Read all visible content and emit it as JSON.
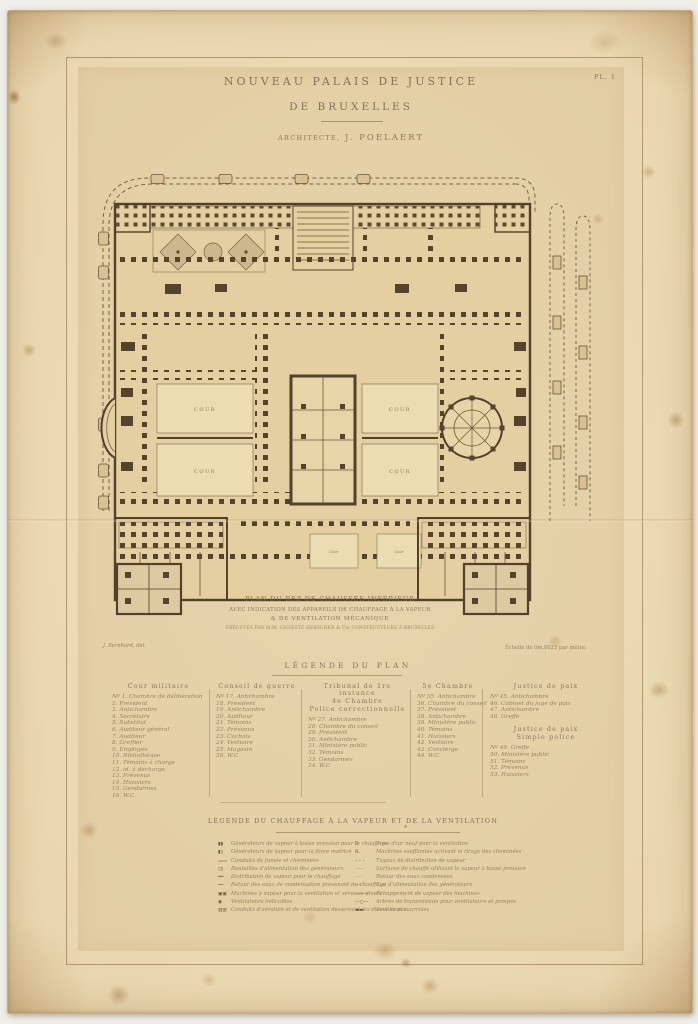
{
  "plate": {
    "number": "PL. 1",
    "title_line1": "NOUVEAU PALAIS DE JUSTICE",
    "title_line2": "DE BRUXELLES",
    "architect_prefix": "ARCHITECTE,",
    "architect_name": "J. POELAERT"
  },
  "plan": {
    "courtyard_label": "COUR",
    "small_court_label": "Cour",
    "caption_line1": "PLAN DU REZ DE CHAUSSÉE INFÉRIEUR",
    "caption_line2": "AVEC INDICATION DES APPAREILS DE CHAUFFAGE À LA VAPEUR",
    "caption_line3": "& DE VENTILATION MÉCANIQUE",
    "caption_line4": "EXÉCUTÉS PAR M.M. GENESTE HERSCHER & Cie CONSTRUCTEURS À BRUXELLES",
    "credit_left": "J. Bernhard, del.",
    "scale_note": "Échelle de 0m,0025 par mètre."
  },
  "legend_plan": {
    "heading": "LÉGENDE DU PLAN",
    "col1": {
      "title": "Cour militaire",
      "items": [
        "Nº 1. Chambre de délibération",
        "2. Président",
        "3. Antichambre",
        "4. Secrétaire",
        "5. Substitut",
        "6. Auditeur général",
        "7. Auditeur",
        "8. Greffier",
        "9. Employés",
        "10. Bibliothèque",
        "11. Témoins à charge",
        "12. id. à décharge",
        "13. Prévenus",
        "14. Huissiers",
        "15. Gendarmes",
        "16. W.C."
      ]
    },
    "col2": {
      "title": "Conseil de guerre",
      "items": [
        "Nº 17. Antichambre",
        "18. Président",
        "19. Antichambre",
        "20. Auditeur",
        "21. Témoins",
        "22. Prévenus",
        "23. Cachots",
        "24. Vestiaire",
        "25. Magasin",
        "26. W.C."
      ]
    },
    "col3": {
      "title1": "Tribunal de 1re instance",
      "title2": "4e Chambre",
      "title3": "Police correctionnelle",
      "items": [
        "Nº 27. Antichambre",
        "28. Chambre du conseil",
        "29. Président",
        "30. Antichambre",
        "31. Ministère public",
        "32. Témoins",
        "33. Gendarmes",
        "34. W.C."
      ]
    },
    "col4": {
      "title": "5e Chambre",
      "items": [
        "Nº 35. Antichambre",
        "36. Chambre du conseil",
        "37. Président",
        "38. Antichambre",
        "39. Ministère public",
        "40. Témoins",
        "41. Huissiers",
        "42. Vestiaire",
        "43. Concierge",
        "44. W.C."
      ]
    },
    "col5": {
      "title": "Justice de paix",
      "items": [
        "Nº 45. Antichambre",
        "46. Cabinet du juge de paix",
        "47. Antichambre",
        "48. Greffe"
      ],
      "title2a": "Justice de paix",
      "title2b": "Simple police",
      "items2": [
        "Nº 49. Greffe",
        "50. Ministère public",
        "51. Témoins",
        "52. Prévenus",
        "53. Huissiers"
      ]
    }
  },
  "legend_chauffage": {
    "heading": "LÉGENDE DU CHAUFFAGE À LA VAPEUR ET DE LA VENTILATION",
    "star": "*",
    "left_items": [
      {
        "sym": "▮▮",
        "text": "Générateurs de vapeur à basse pression pour le chauffage"
      },
      {
        "sym": "▮▯",
        "text": "Générateurs de vapeur pour la force motrice"
      },
      {
        "sym": "▭▭",
        "text": "Conduits de fumée et cheminées"
      },
      {
        "sym": "▯▯",
        "text": "Bouteilles d'alimentation des générateurs"
      },
      {
        "sym": "══",
        "text": "Distribution de vapeur pour le chauffage"
      },
      {
        "sym": "╍╍",
        "text": "Retour des eaux de condensation provenant du chauffage"
      },
      {
        "sym": "▣▣",
        "text": "Machines à vapeur pour la ventilation et services divers"
      },
      {
        "sym": "◉",
        "text": "Ventilateurs hélicoïdes"
      },
      {
        "sym": "▥▥",
        "text": "Conduits d'aération et de ventilation desservant les divers locaux"
      }
    ],
    "right_items": [
      {
        "sym": "F.",
        "text": "Prise d'air neuf pour la ventilation"
      },
      {
        "sym": "R.",
        "text": "Machines soufflantes activant le tirage des cheminées"
      },
      {
        "sym": "– – –",
        "text": "Tuyaux de distribution de vapeur"
      },
      {
        "sym": "·–·–",
        "text": "Surfaces de chauffe utilisant la vapeur à basse pression"
      },
      {
        "sym": "· · ·",
        "text": "Retour des eaux condensées"
      },
      {
        "sym": "–·–",
        "text": "Eau d'alimentation des générateurs"
      },
      {
        "sym": "———",
        "text": "Échappement de vapeur des machines"
      },
      {
        "sym": "—○—",
        "text": "Arbres de transmission pour ventilateurs et pompes"
      },
      {
        "sym": "▬▬",
        "text": "Poulies et courroies"
      }
    ]
  },
  "colors": {
    "paper": "#e9d6ae",
    "plate_tone": "#e3cfa2",
    "ink_dark": "#54402b",
    "ink_faded": "#97825f"
  }
}
